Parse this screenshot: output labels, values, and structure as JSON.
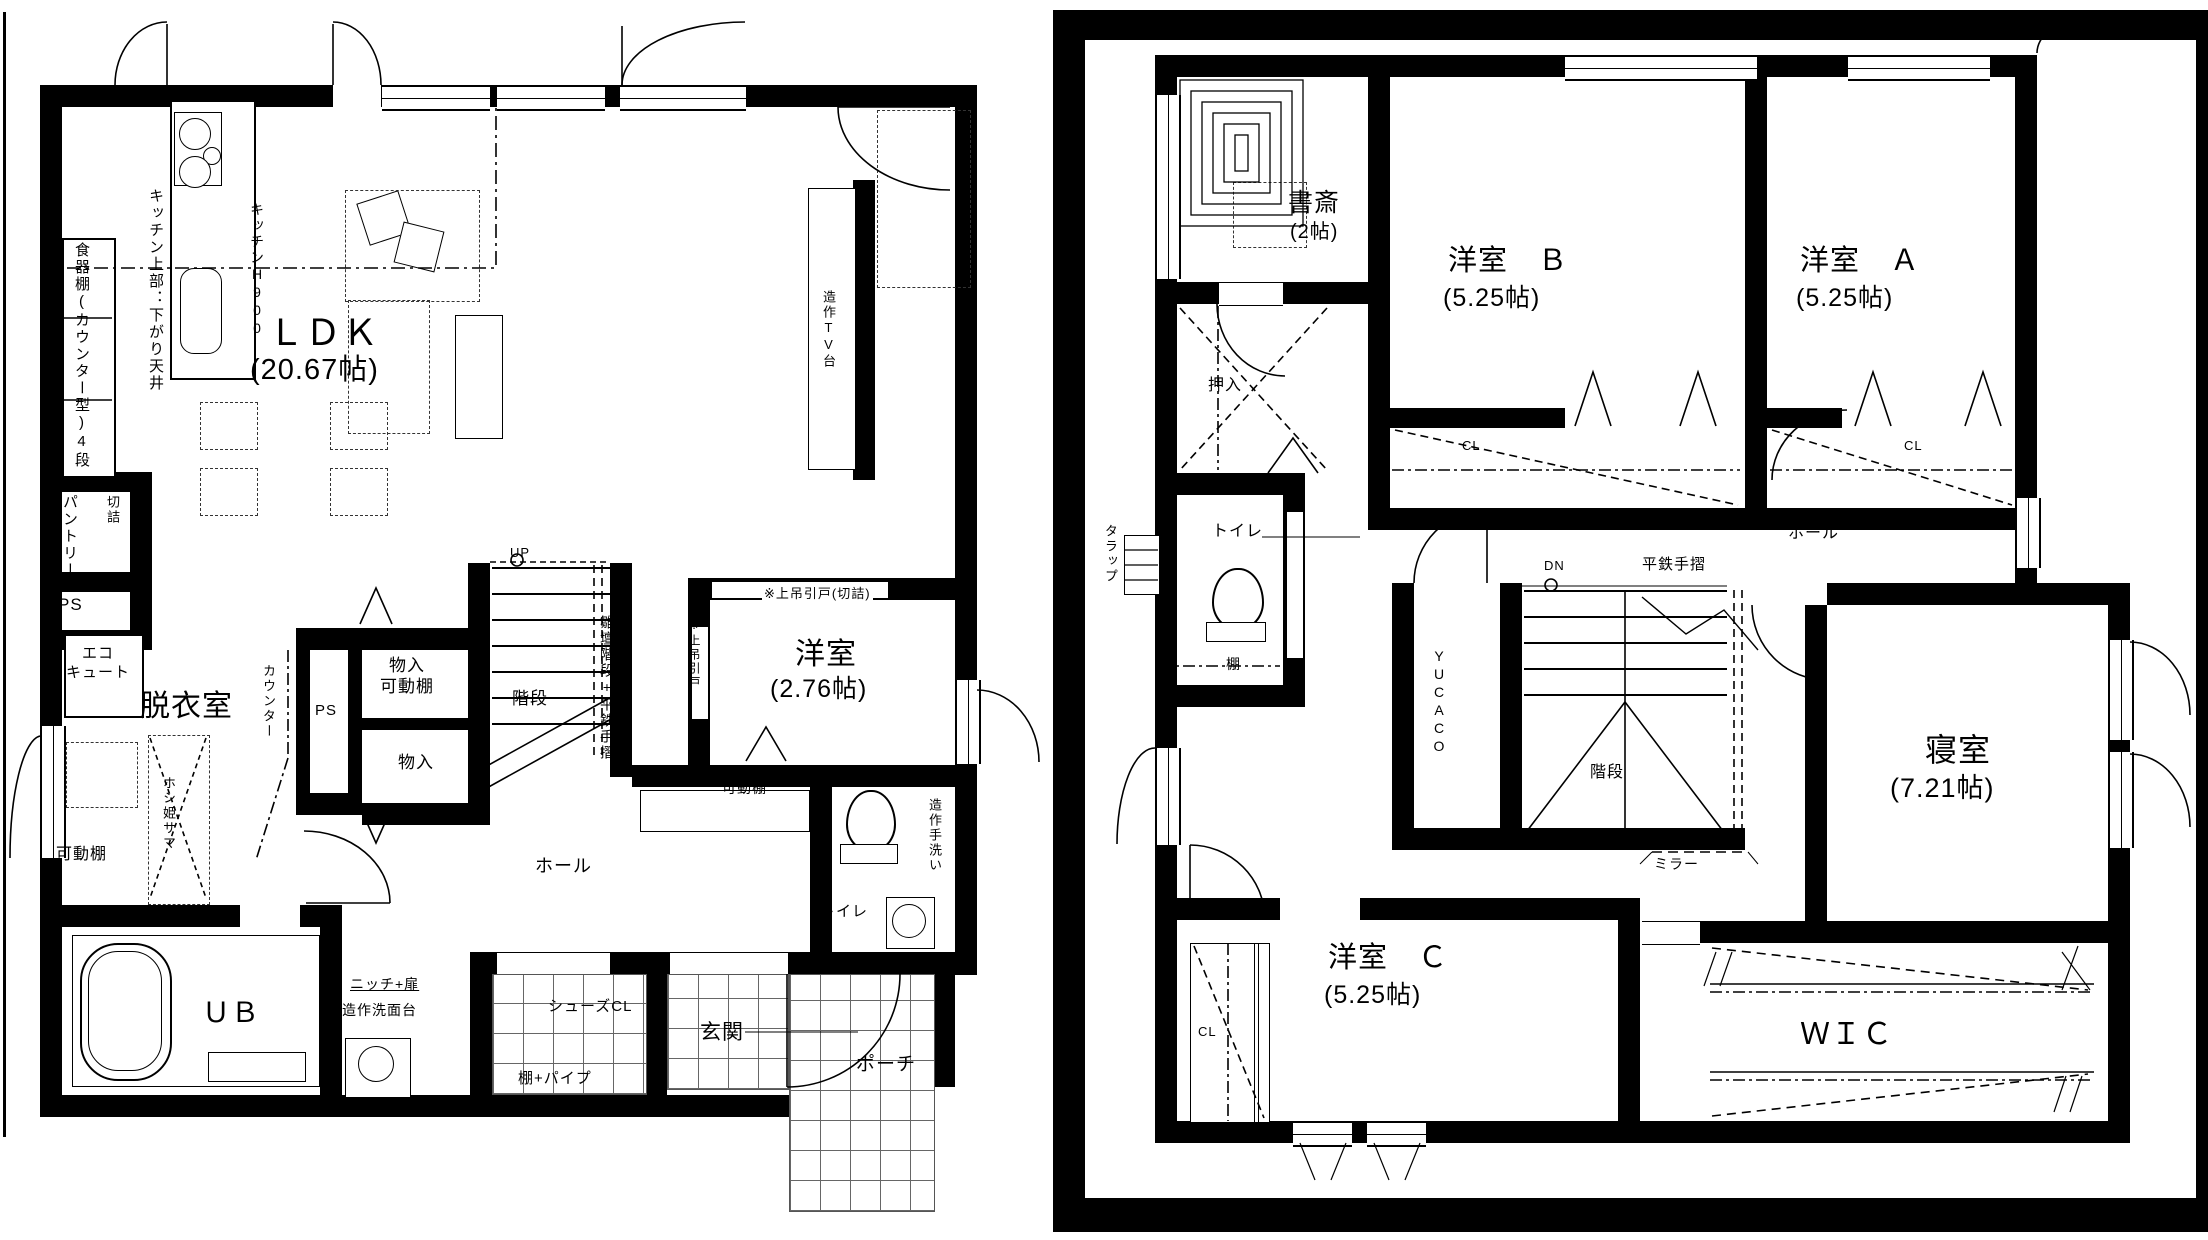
{
  "f1": {
    "cupboard": "食器棚(カウンター型)4段",
    "kitchen_upper": "キッチン上部：下がり天井",
    "kitchen_h": "キッチンH900",
    "ldk": "ＬＤＫ",
    "ldk_size": "(20.67帖)",
    "kiritsume": "※切詰",
    "pantry": "パントリー",
    "ps1": "PS",
    "ps2": "PS",
    "ecocute": "エコ\nキュート",
    "datsuishitsu": "脱衣室",
    "counter": "カウンター",
    "kadodana": "可動棚",
    "hoshihime": "ホシ姫サマ",
    "ub": "ＵＢ",
    "niche": "ニッチ+扉",
    "washstand": "造作洗面台",
    "storage1": "物入\n可動棚",
    "storage2": "物入",
    "stairs": "階段",
    "stair_note": "雛壇階段+平鉄手摺",
    "up": "UP",
    "hall": "ホール",
    "slide_note": "※上吊引戸(切詰)",
    "slide_note2": "※上吊引戸",
    "room": "洋室",
    "room_size": "(2.76帖)",
    "kadodana2": "可動棚",
    "toilet": "トイレ",
    "handwash": "造作手洗い",
    "genkan": "玄関",
    "shoes": "シューズCL",
    "shelf_pipe": "棚+パイプ",
    "porch": "ポーチ",
    "tv": "造作TV台"
  },
  "f2": {
    "study": "書斎",
    "study_size": "(2帖)",
    "room_b": "洋室　Ｂ",
    "room_b_size": "(5.25帖)",
    "room_a": "洋室　Ａ",
    "room_a_size": "(5.25帖)",
    "oshiire": "押入",
    "cl_b": "CL",
    "cl_a": "CL",
    "cl_c": "CL",
    "tarap": "タラップ",
    "toilet": "トイレ",
    "tana": "棚",
    "hall": "ホール",
    "handrail": "平鉄手摺",
    "dn": "DN",
    "yucaco": "YUCACO",
    "stairs": "階段",
    "mirror": "ミラー",
    "bedroom": "寝室",
    "bedroom_size": "(7.21帖)",
    "room_c": "洋室　Ｃ",
    "room_c_size": "(5.25帖)",
    "wic": "ＷＩＣ"
  }
}
